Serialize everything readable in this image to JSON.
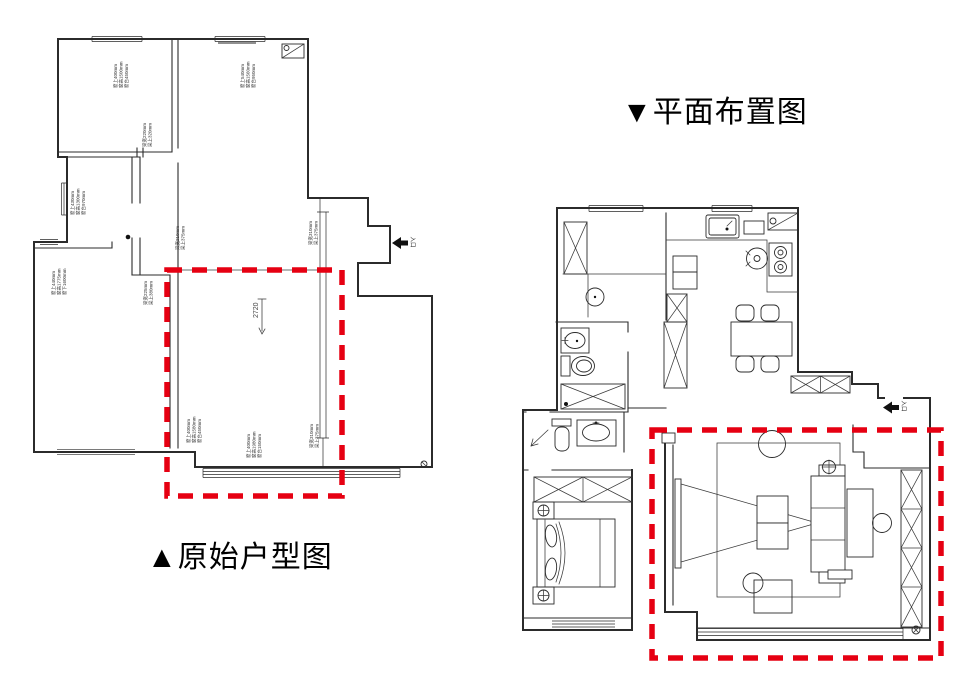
{
  "colors": {
    "highlight-red": "#e60012",
    "line": "#2b2b2b"
  },
  "original_plan": {
    "title": "▲原始户型图",
    "entrance_label": "入口",
    "room_dimension": "2720",
    "annotations": [
      {
        "lines": [
          "窗上400mm",
          "窗高1500mm",
          "窗台450mm"
        ]
      },
      {
        "lines": [
          "梁宽220mm",
          "梁上320mm"
        ]
      },
      {
        "lines": [
          "窗上540mm",
          "窗高1560mm",
          "窗台950mm"
        ]
      },
      {
        "lines": [
          "窗上430mm",
          "窗高1300mm",
          "窗台970mm"
        ]
      },
      {
        "lines": [
          "窗上440mm",
          "窗高1775mm",
          "窗下1600mm"
        ]
      },
      {
        "lines": [
          "梁宽225mm",
          "梁上380mm"
        ]
      },
      {
        "lines": [
          "梁宽210mm",
          "梁上375mm"
        ]
      },
      {
        "lines": [
          "梁宽310mm",
          "梁上375mm"
        ]
      },
      {
        "lines": [
          "窗上400mm",
          "窗高1580mm",
          "窗台450mm"
        ]
      },
      {
        "lines": [
          "窗上400mm",
          "窗高1980mm",
          "窗台150mm"
        ]
      },
      {
        "lines": [
          "梁宽310mm",
          "梁上375mm"
        ]
      }
    ]
  },
  "layout_plan": {
    "title": "▼平面布置图",
    "entrance_label": "入口"
  }
}
